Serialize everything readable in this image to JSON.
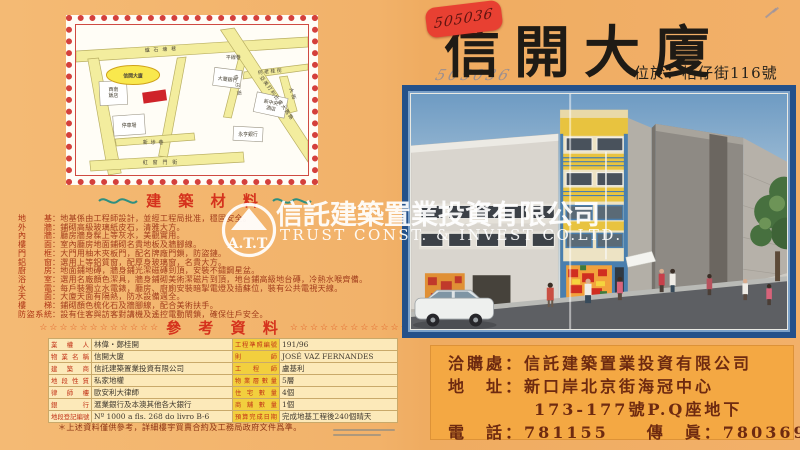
{
  "brochure": {
    "left": {
      "map": {
        "building_label": "信開大廈",
        "street_top": "爐石塘巷",
        "street_bottom": "紅窗門街",
        "street_mid": "新埗巷",
        "street_vertical": "桔仔街",
        "street_right_small": "何老桂街",
        "street_lane": "平線巷",
        "street_avenue": "亞美打利比盧大馬路",
        "street_main": "大街",
        "place_restaurant_1": "西南",
        "place_restaurant_2": "飯店",
        "place_carpark": "停車場",
        "place_bank1": "大豐銀行",
        "place_hotel_1": "新中央",
        "place_hotel_2": "酒店",
        "place_bank2": "永亨銀行"
      },
      "materials": {
        "title": "建 築 材 料",
        "rows": [
          {
            "label": "地　基",
            "text": "：地基係由工程師設計，並經工程局批准，穩固安全。"
          },
          {
            "label": "外　牆",
            "text": "：鋪砌高級玻璃紙皮石，清雅大方。"
          },
          {
            "label": "內　牆",
            "text": "：廳房牆身髹上等灰水，美觀實用。"
          },
          {
            "label": "樓　面",
            "text": "：室內廳房地面鋪砌名貴地板及牆腳線。"
          },
          {
            "label": "門　框",
            "text": "：大門用柚木夾板門，配名牌廠門鎖，防盜鏈。"
          },
          {
            "label": "鋁　窗",
            "text": "：選用上等鋁質窗，配厚身玻璃窗，名貴大方。"
          },
          {
            "label": "廚　房",
            "text": "：地面鋪地磚，牆身鋪光潔磁磚到頂，安裝不鏽鋼星盆。"
          },
          {
            "label": "浴　室",
            "text": "：選用名廠顏色潔具，牆身鋪砌美術潔磁片到頂，地台鋪高級地台磚，冷熱水喉齊備。"
          },
          {
            "label": "水　電",
            "text": "：每戶裝獨立水電錶，廳房、廚廁安裝暗掣電燈及插蘇位，裝有公共電視天線。"
          },
          {
            "label": "天　面",
            "text": "：大廈天面有隔熱，防水設備週全。"
          },
          {
            "label": "樓　梯",
            "text": "：鋪砌顏色梳化石及牆腳線，配合美術扶手。"
          },
          {
            "label": "防盜系統",
            "text": "：設有住客與訪客對講機及遙控電動閘鎖，確保住戶安全。"
          }
        ]
      },
      "reference": {
        "title": "參 考 資 料",
        "stars_left": "☆☆☆☆☆☆☆☆☆☆☆☆",
        "stars_right": "☆☆☆☆☆☆☆☆☆☆☆☆",
        "rows": [
          {
            "l1": "業權人",
            "v1": "林偉・鄭桂開",
            "l2": "工程準照編號",
            "v2": "191/96"
          },
          {
            "l1": "物業名稱",
            "v1": "信開大廈",
            "l2": "則師",
            "v2": "JOSÉ VAZ FERNANDES"
          },
          {
            "l1": "建築商",
            "v1": "信託建築置業投資有限公司",
            "l2": "工程師",
            "v2": "盧基利"
          },
          {
            "l1": "地段性質",
            "v1": "私家地權",
            "l2": "物業層數量",
            "v2": "5層"
          },
          {
            "l1": "律師樓",
            "v1": "歐安利大律師",
            "l2": "住宅數量",
            "v2": "4個"
          },
          {
            "l1": "銀行",
            "v1": "滙業銀行及本澳其他各大銀行",
            "l2": "商舖數量",
            "v2": "1個"
          },
          {
            "l1": "地段登記編號",
            "v1": "Nº 1000 a fls. 268 do livro B-6",
            "l2": "預算完成日期",
            "v2": "完成地基工程後240個晴天"
          }
        ],
        "footnote": "＊上述資料僅供參考，詳細樓宇買賣合約及工務局政府文件爲準。"
      }
    },
    "right": {
      "sticker": "505036",
      "pencil": "505036",
      "title": "信開大廈",
      "location": "位於：桔仔街116號",
      "contact": {
        "line1": "洽購處：信託建築置業投資有限公司",
        "line2": "地　址：新口岸北京街海冠中心",
        "line3": "173-177號P.Q座地下",
        "line4": "電　話：781155　　傳　眞：780369"
      }
    },
    "watermark": {
      "logo_text": "A.T.T.",
      "company_cn": "信託建築置業投資有限公司",
      "company_en": "TRUST CONST. & INVEST CO.LTD."
    }
  }
}
